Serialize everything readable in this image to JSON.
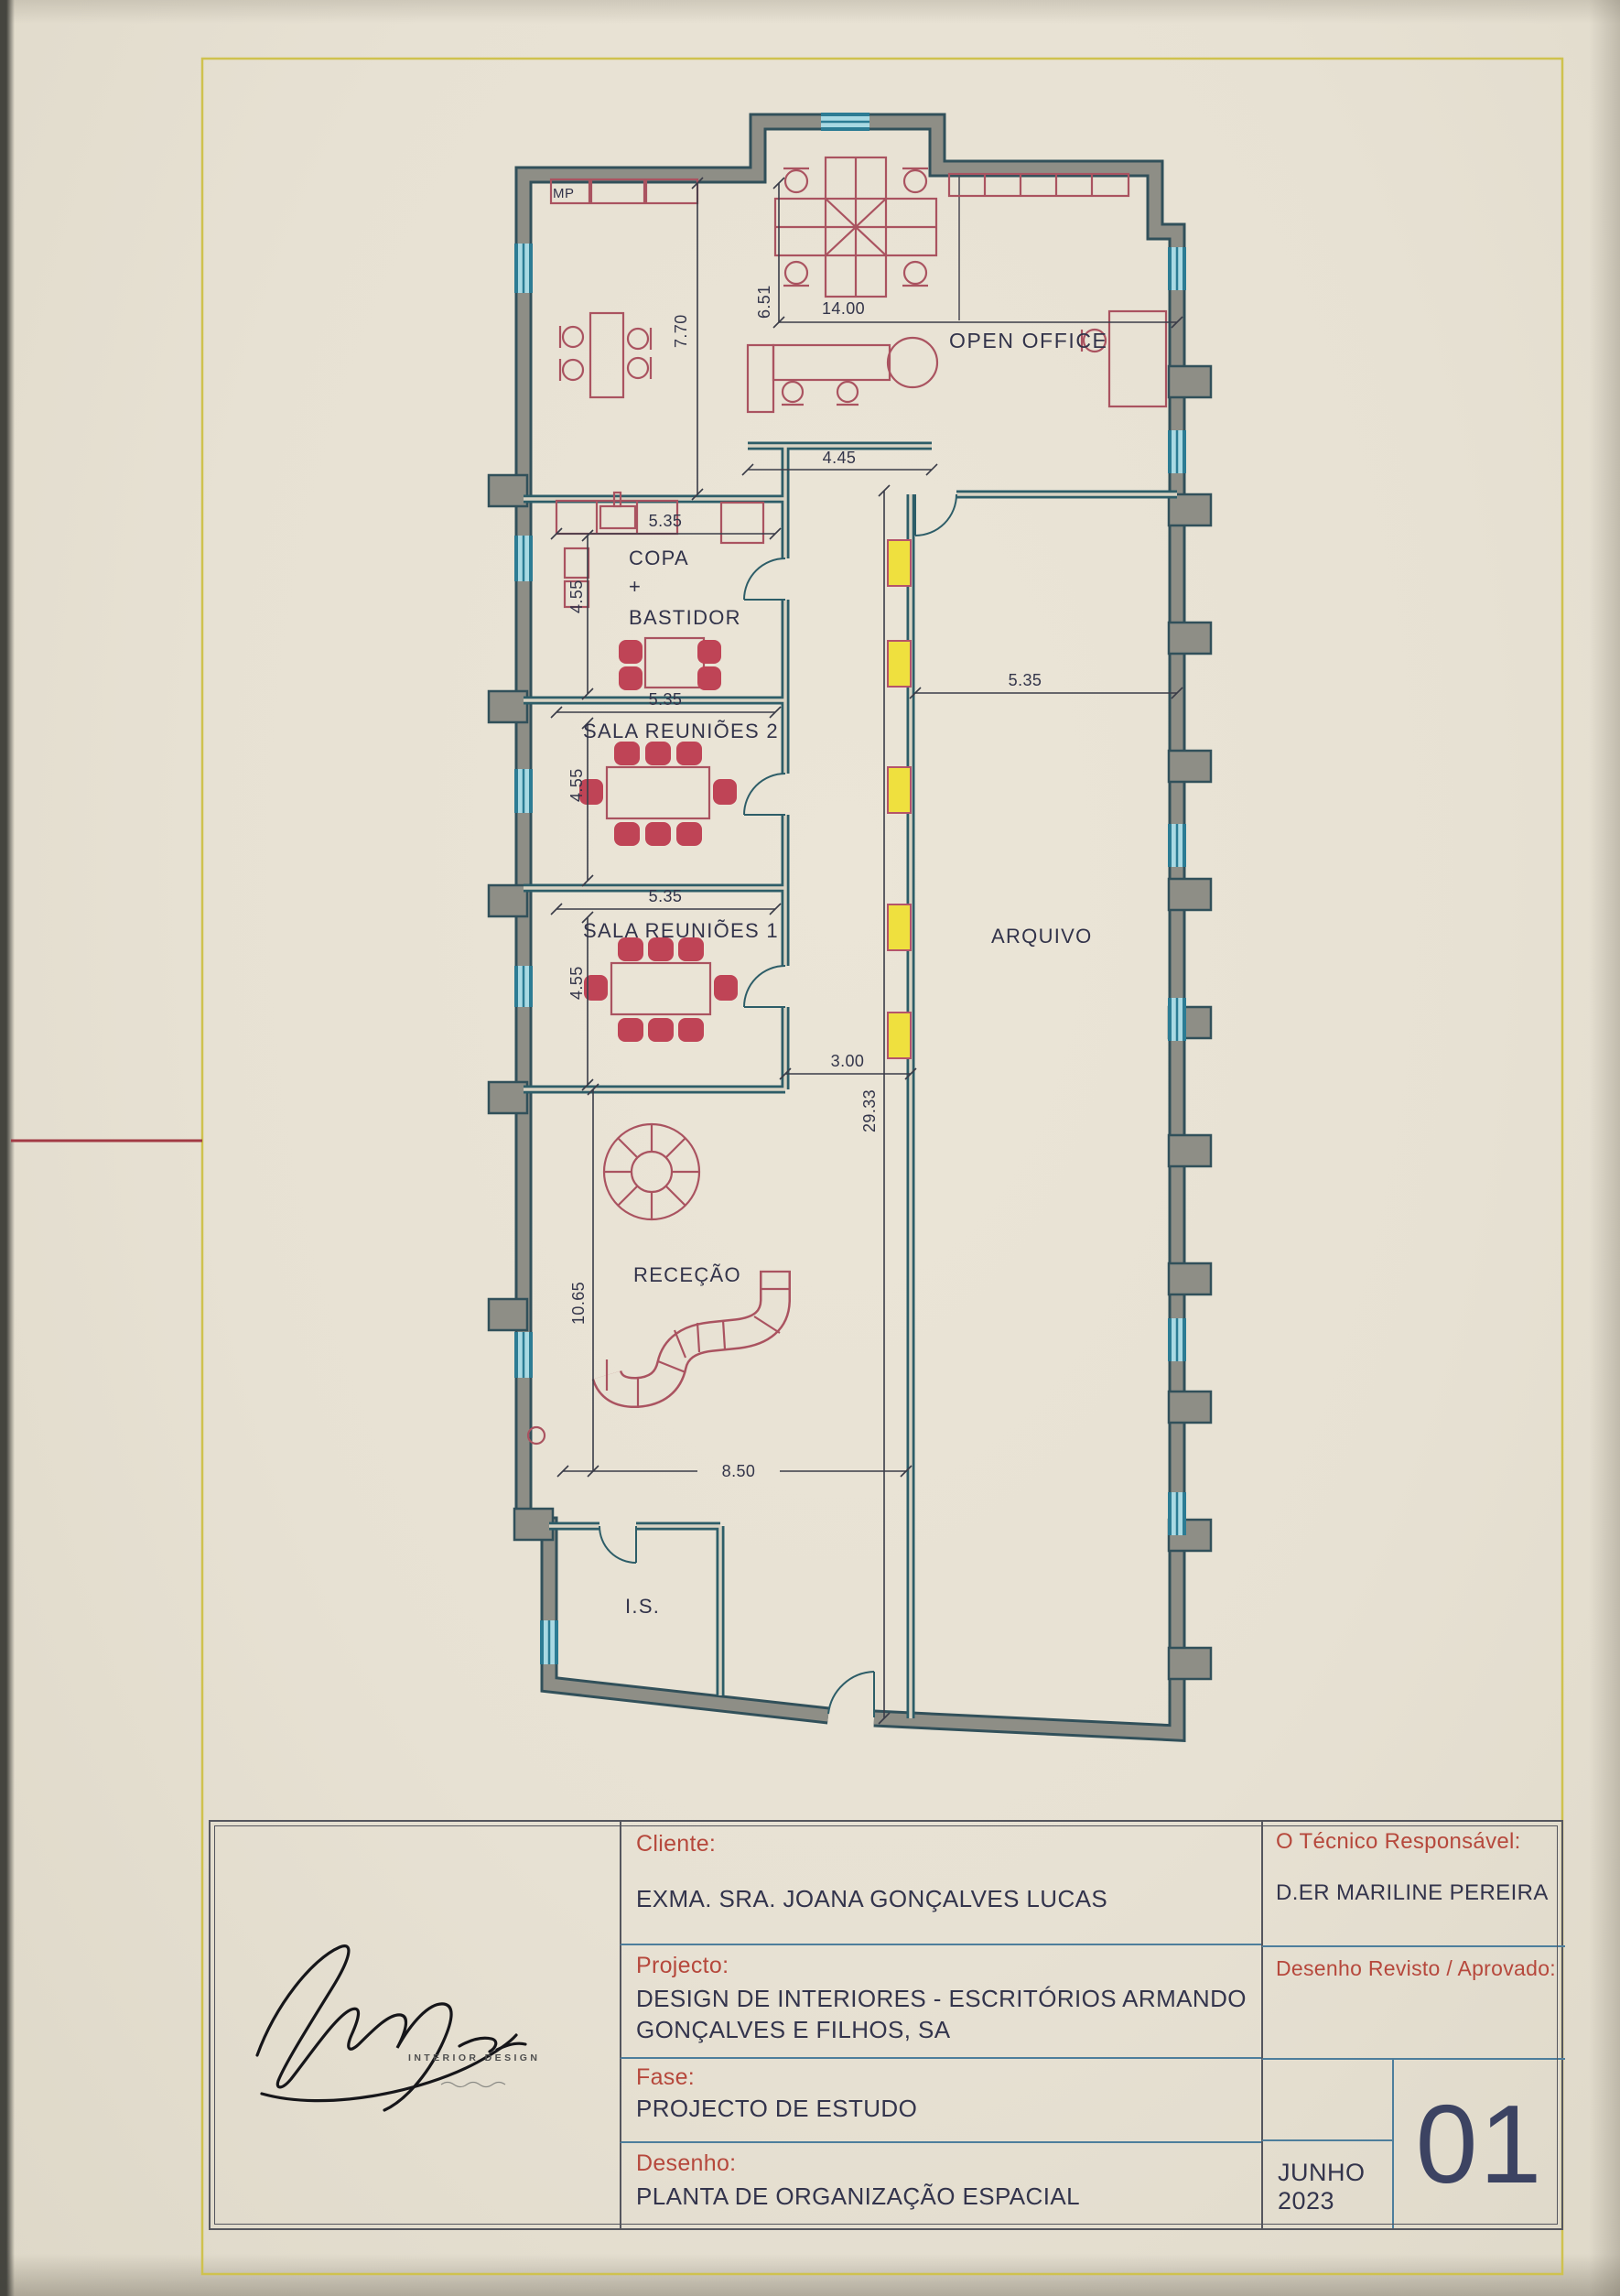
{
  "plan": {
    "rooms": {
      "mp": "MP",
      "open_office": "OPEN OFFICE",
      "copa": "COPA",
      "plus": "+",
      "bastidor": "BASTIDOR",
      "sala_reunioes_2": "SALA REUNIÕES 2",
      "sala_reunioes_1": "SALA REUNIÕES 1",
      "arquivo": "ARQUIVO",
      "rececao": "RECEÇÃO",
      "is": "I.S."
    },
    "dimensions": {
      "top_height": "6.51",
      "top_width": "14.00",
      "left_height": "7.70",
      "partition": "4.45",
      "copa_w": "5.35",
      "copa_h": "4.55",
      "sala2_w": "5.35",
      "sala2_h": "4.55",
      "sala1_w": "5.35",
      "sala1_h": "4.55",
      "arquivo_w": "5.35",
      "corridor_w": "3.00",
      "corridor_len": "29.33",
      "rececao_h": "10.65",
      "rececao_w": "8.50"
    }
  },
  "title_block": {
    "logo_text": "INTERIOR DESIGN",
    "cliente_label": "Cliente:",
    "cliente_value": "EXMA. SRA. JOANA GONÇALVES LUCAS",
    "projecto_label": "Projecto:",
    "projecto_value_line1": "DESIGN DE INTERIORES - ESCRITÓRIOS ARMANDO",
    "projecto_value_line2": "GONÇALVES E FILHOS, SA",
    "fase_label": "Fase:",
    "fase_value": "PROJECTO DE ESTUDO",
    "desenho_label": "Desenho:",
    "desenho_value": "PLANTA DE ORGANIZAÇÃO ESPACIAL",
    "tecnico_label": "O Técnico Responsável:",
    "tecnico_value": "D.ER MARILINE PEREIRA",
    "revisto_label": "Desenho Revisto / Aprovado:",
    "date_value": "JUNHO 2023",
    "sheet_number": "01"
  },
  "colors": {
    "paper": "#e8e2d4",
    "wall_fill": "#8e8e86",
    "wall_edge": "#31505a",
    "partition": "#2d5d68",
    "window": "#a9d9e3",
    "window_edge": "#2c7c94",
    "furniture_red": "#aa5360",
    "chair_red": "#bf4456",
    "highlight_yellow": "#efe03e",
    "label_red": "#b6483c",
    "text_dark": "#33344c",
    "grid_blue": "#4d7e9c",
    "frame_yellow": "#cfc24e",
    "fold_red": "#a23a44"
  }
}
